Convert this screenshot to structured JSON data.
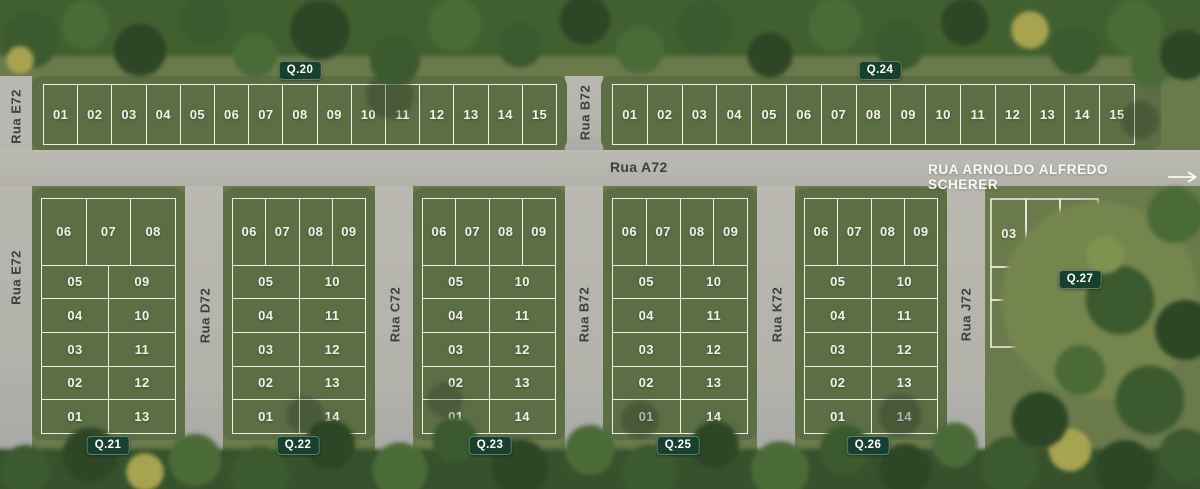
{
  "plan": {
    "name": "Mapa do loteamento - quadras e lotes"
  },
  "colors": {
    "grass": "#6a7a4b",
    "block_green": "#5b6e44",
    "road_gray": "#b7b6ae",
    "lot_outline": "#efeee6",
    "badge_bg": "#17402f",
    "badge_text": "#ffffff",
    "street_text": "#3d403c",
    "avenue_text": "#fbfaf4",
    "forest_dark": "#2d4726"
  },
  "avenue": {
    "name_left": "Rua A72",
    "name_right": "RUA ARNOLDO ALFREDO SCHERER"
  },
  "streets": {
    "e72_top": "Rua E72",
    "b72_top": "Rua B72",
    "e72_bottom": "Rua E72",
    "d72": "Rua D72",
    "c72": "Rua C72",
    "b72_bottom": "Rua B72",
    "k72": "Rua K72",
    "j72": "Rua J72"
  },
  "blocks": {
    "q20": {
      "badge": "Q.20",
      "lots": [
        "01",
        "02",
        "03",
        "04",
        "05",
        "06",
        "07",
        "08",
        "09",
        "10",
        "11",
        "12",
        "13",
        "14",
        "15"
      ]
    },
    "q24": {
      "badge": "Q.24",
      "lots": [
        "01",
        "02",
        "03",
        "04",
        "05",
        "06",
        "07",
        "08",
        "09",
        "10",
        "11",
        "12",
        "13",
        "14",
        "15"
      ]
    },
    "q21": {
      "badge": "Q.21",
      "top_row": [
        "06",
        "07",
        "08"
      ],
      "left_col": [
        "05",
        "04",
        "03",
        "02",
        "01"
      ],
      "right_col": [
        "09",
        "10",
        "11",
        "12",
        "13"
      ]
    },
    "q22": {
      "badge": "Q.22",
      "top_row": [
        "06",
        "07",
        "08",
        "09"
      ],
      "left_col": [
        "05",
        "04",
        "03",
        "02",
        "01"
      ],
      "right_col": [
        "10",
        "11",
        "12",
        "13",
        "14"
      ]
    },
    "q23": {
      "badge": "Q.23",
      "top_row": [
        "06",
        "07",
        "08",
        "09"
      ],
      "left_col": [
        "05",
        "04",
        "03",
        "02",
        "01"
      ],
      "right_col": [
        "10",
        "11",
        "12",
        "13",
        "14"
      ]
    },
    "q25": {
      "badge": "Q.25",
      "top_row": [
        "06",
        "07",
        "08",
        "09"
      ],
      "left_col": [
        "05",
        "04",
        "03",
        "02",
        "01"
      ],
      "right_col": [
        "10",
        "11",
        "12",
        "13",
        "14"
      ]
    },
    "q26": {
      "badge": "Q.26",
      "top_row": [
        "06",
        "07",
        "08",
        "09"
      ],
      "left_col": [
        "05",
        "04",
        "03",
        "02",
        "01"
      ],
      "right_col": [
        "10",
        "11",
        "12",
        "13",
        "14"
      ]
    },
    "q27": {
      "badge": "Q.27",
      "top_row": [
        "03",
        "04",
        "05"
      ],
      "mid_row": [
        "02"
      ],
      "bottom_row": [
        "01"
      ]
    }
  }
}
